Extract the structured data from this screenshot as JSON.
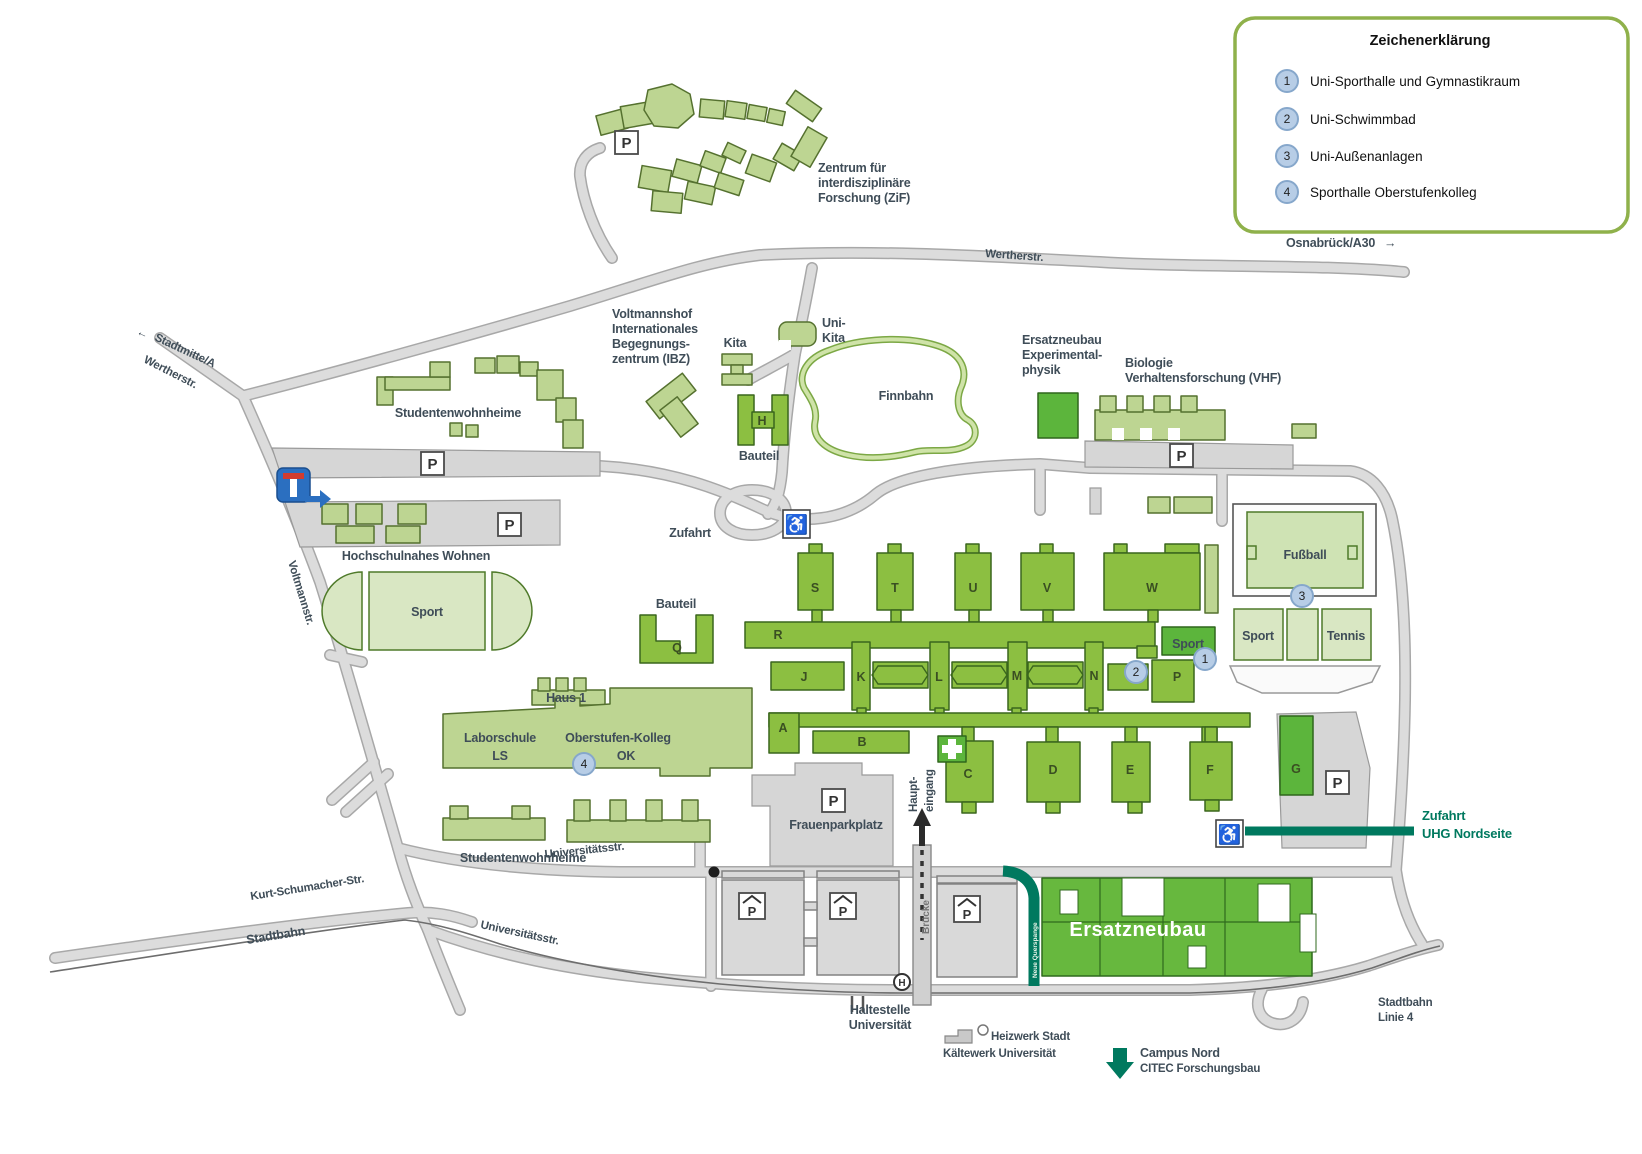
{
  "legend": {
    "title": "Zeichenerklärung",
    "items": [
      {
        "num": "1",
        "label": "Uni-Sporthalle und Gymnastikraum"
      },
      {
        "num": "2",
        "label": "Uni-Schwimmbad"
      },
      {
        "num": "3",
        "label": "Uni-Außenanlagen"
      },
      {
        "num": "4",
        "label": "Sporthalle Oberstufenkolleg"
      }
    ]
  },
  "streets": {
    "stadtmitte": "Stadtmitte/A",
    "wertherstr_left": "Wertherstr.",
    "wertherstr_top": "Wertherstr.",
    "osnabrueck": "Osnabrück/A30",
    "voltmannstr": "Voltmannstr.",
    "kurt_schumacher": "Kurt-Schumacher-Str.",
    "stadtbahn": "Stadtbahn",
    "universitaetsstr_upper": "Universitätsstr.",
    "universitaetsstr_lower": "Universitätsstr.",
    "stadtbahn_linie4": [
      "Stadtbahn",
      "Linie 4"
    ],
    "bruecke": "Brücke",
    "zufahrt": "Zufahrt",
    "neue_querspange": "Neue Querspange"
  },
  "sites": {
    "zif": [
      "Zentrum für",
      "interdisziplinäre",
      "Forschung (ZiF)"
    ],
    "studentenwohnheime_nord": "Studentenwohnheime",
    "studentenwohnheime_sued": "Studentenwohnheime",
    "hochschulnahes_wohnen": "Hochschulnahes Wohnen",
    "voltmannshof": [
      "Voltmannshof",
      "Internationales",
      "Begegnungs-",
      "zentrum (IBZ)"
    ],
    "kita": "Kita",
    "uni_kita": [
      "Uni-",
      "Kita"
    ],
    "bauteil_h": "Bauteil",
    "bauteil_q": "Bauteil",
    "finnbahn": "Finnbahn",
    "ersatzneubau_physik": [
      "Ersatzneubau",
      "Experimental-",
      "physik"
    ],
    "biologie": [
      "Biologie",
      "Verhaltensforschung (VHF)"
    ],
    "sport_oval": "Sport",
    "haus1": "Haus 1",
    "laborschule": [
      "Laborschule",
      "LS"
    ],
    "oberstufen_kolleg": [
      "Oberstufen-Kolleg",
      "OK"
    ],
    "frauenparkplatz": "Frauenparkplatz",
    "fussball": "Fußball",
    "sport_court": "Sport",
    "tennis": "Tennis",
    "sport_halle": "Sport",
    "haupteingang": [
      "Haupt-",
      "eingang"
    ],
    "haltestelle": [
      "Haltestelle",
      "Universität"
    ],
    "heizwerk": [
      "Heizwerk Stadt",
      "Kältewerk Universität"
    ],
    "campus_nord": [
      "Campus Nord",
      "CITEC Forschungsbau"
    ],
    "ersatzneubau_sued": "Ersatzneubau",
    "zufahrt_uhg": [
      "Zufahrt",
      "UHG Nordseite"
    ]
  },
  "letters": {
    "s": "S",
    "t": "T",
    "u": "U",
    "v": "V",
    "w": "W",
    "r": "R",
    "j": "J",
    "k": "K",
    "l": "L",
    "m": "M",
    "n": "N",
    "p": "P",
    "a": "A",
    "b": "B",
    "c": "C",
    "d": "D",
    "e": "E",
    "f": "F",
    "g": "G",
    "h": "H",
    "q": "Q"
  },
  "markers": {
    "parking": "P",
    "stop_h": "H",
    "badges": [
      "1",
      "2",
      "3",
      "4"
    ],
    "arrow_left": "←",
    "arrow_right": "→"
  },
  "icons": {
    "wheelchair": "♿"
  },
  "colors": {
    "building_light": "#bdd592",
    "building_mid": "#8cbf41",
    "building_dark": "#5cb53c",
    "field_light": "#d9e7c3",
    "accent_teal": "#00795f",
    "road_fill": "#dcdcdc",
    "legend_border": "#8fb14b",
    "badge_fill": "#b7cde6",
    "sign_blue": "#2b6fc0",
    "label_dark": "#3f4d58"
  }
}
